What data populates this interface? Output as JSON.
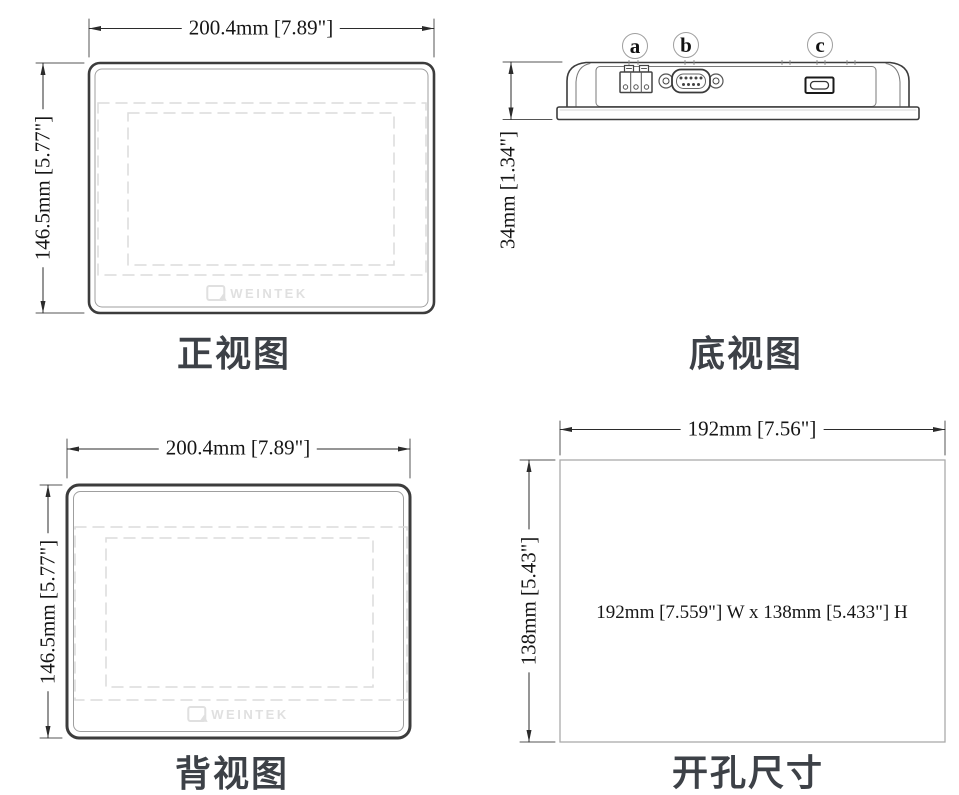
{
  "drawing": {
    "brand": "WEINTEK",
    "views": {
      "front": {
        "title": "正视图",
        "width_label": "200.4mm [7.89\"]",
        "height_label": "146.5mm [5.77\"]"
      },
      "bottom": {
        "title": "底视图",
        "height_label": "34mm [1.34\"]",
        "connectors": [
          {
            "label": "a",
            "name": "power-terminal-block"
          },
          {
            "label": "b",
            "name": "serial-db9-port"
          },
          {
            "label": "c",
            "name": "micro-usb-port"
          }
        ]
      },
      "back": {
        "title": "背视图",
        "width_label": "200.4mm [7.89\"]",
        "height_label": "146.5mm [5.77\"]"
      },
      "cutout": {
        "title": "开孔尺寸",
        "width_label": "192mm [7.56\"]",
        "height_label": "138mm [5.43\"]",
        "inner_label": "192mm [7.559\"] W x 138mm [5.433\"] H"
      }
    },
    "colors": {
      "background": "#ffffff",
      "line_dark": "#3c3c3c",
      "line_light": "#9f9f9f",
      "dashed_line": "#dcdcdc",
      "dimension_line": "#2b2b2b",
      "title_text": "#3d4147",
      "logo_gray": "#e0e0e0"
    }
  }
}
